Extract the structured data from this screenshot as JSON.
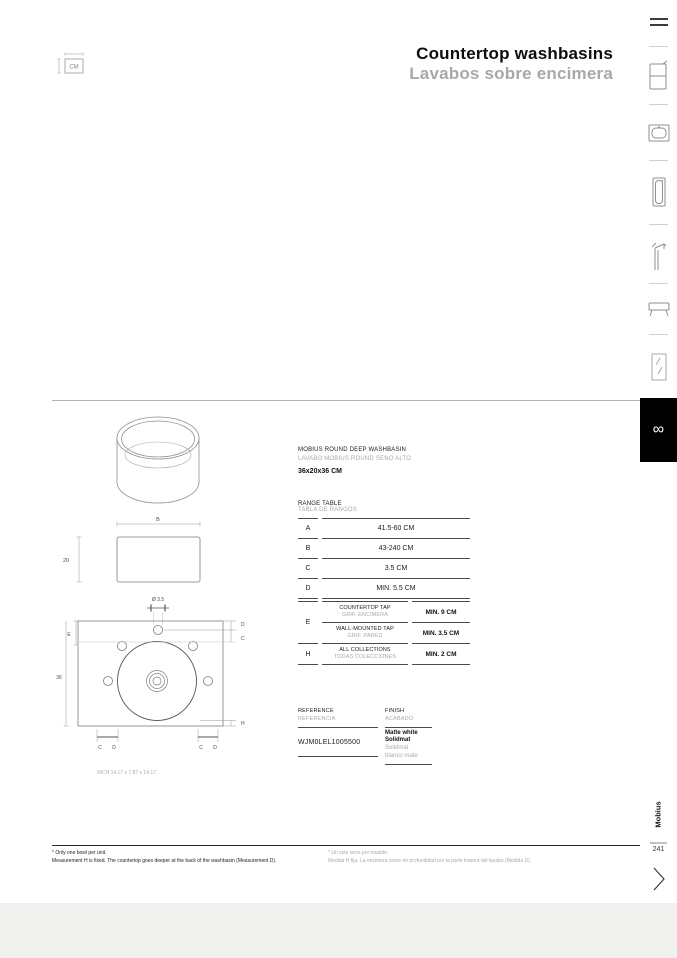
{
  "header": {
    "title_en": "Countertop washbasins",
    "title_es": "Lavabos sobre encimera",
    "unit_label": "CM"
  },
  "sidebar": {
    "items": [
      {
        "name": "menu"
      },
      {
        "name": "vanity-cabinet"
      },
      {
        "name": "countertop-washbasin"
      },
      {
        "name": "pedestal-washbasin"
      },
      {
        "name": "tap"
      },
      {
        "name": "console"
      },
      {
        "name": "mirror"
      }
    ],
    "logo_glyph": "∞",
    "brand": "Mobius",
    "page_number": "241"
  },
  "product": {
    "name_en": "MOBIUS ROUND DEEP WASHBASIN",
    "name_es": "LAVABO MOBIUS ROUND SENO ALTO",
    "size": "36x20x36 CM"
  },
  "range_table": {
    "title_en": "RANGE TABLE",
    "title_es": "TABLA DE RANGOS",
    "rows": [
      {
        "key": "A",
        "value": "41.5-60 CM"
      },
      {
        "key": "B",
        "value": "43-240 CM"
      },
      {
        "key": "C",
        "value": "3.5 CM"
      },
      {
        "key": "D",
        "value": "MIN. 5.5 CM"
      }
    ],
    "detail": [
      {
        "key": "E",
        "desc_en": "COUNTERTOP TAP",
        "desc_es": "GRIF. ENCIMERA",
        "value": "MIN. 9 CM"
      },
      {
        "key": "",
        "desc_en": "WALL-MOUNTED TAP",
        "desc_es": "GRIF. PARED",
        "value": "MIN. 3.5 CM"
      },
      {
        "key": "H",
        "desc_en": "ALL COLLECTIONS",
        "desc_es": "TODAS COLECCIONES",
        "value": "MIN. 2 CM"
      }
    ]
  },
  "reference": {
    "label_en": "REFERENCE",
    "label_es": "REFERENCIA",
    "code": "WJM0LEL1005500"
  },
  "finish": {
    "label_en": "FINISH",
    "label_es": "ACABADO",
    "lines_black": [
      "Matte white",
      "Solidmat"
    ],
    "lines_gray": [
      "Solidmat",
      "blanco mate"
    ]
  },
  "drawing": {
    "front_width": "B",
    "front_height": "20",
    "hole_diameter": "Ø 3.5",
    "plan_e": "E",
    "plan_d": "D",
    "plan_c": "C",
    "plan_depth": "36",
    "plan_h": "H",
    "bottom_c": "C",
    "bottom_d": "D",
    "inch_note": "INCH 14.17 x 7.87 x 14.17"
  },
  "footnotes": {
    "en_1": "* Only one bowl per unit.",
    "en_2": "Measurement H is fixed. The countertop goes deeper at the back of the washbasin (Measurement D).",
    "es_1": "* Un solo seno por mueble.",
    "es_2": "Medida H fija. La encimera crece en profundidad por la parte trasera del lavabo (Medida D)."
  }
}
